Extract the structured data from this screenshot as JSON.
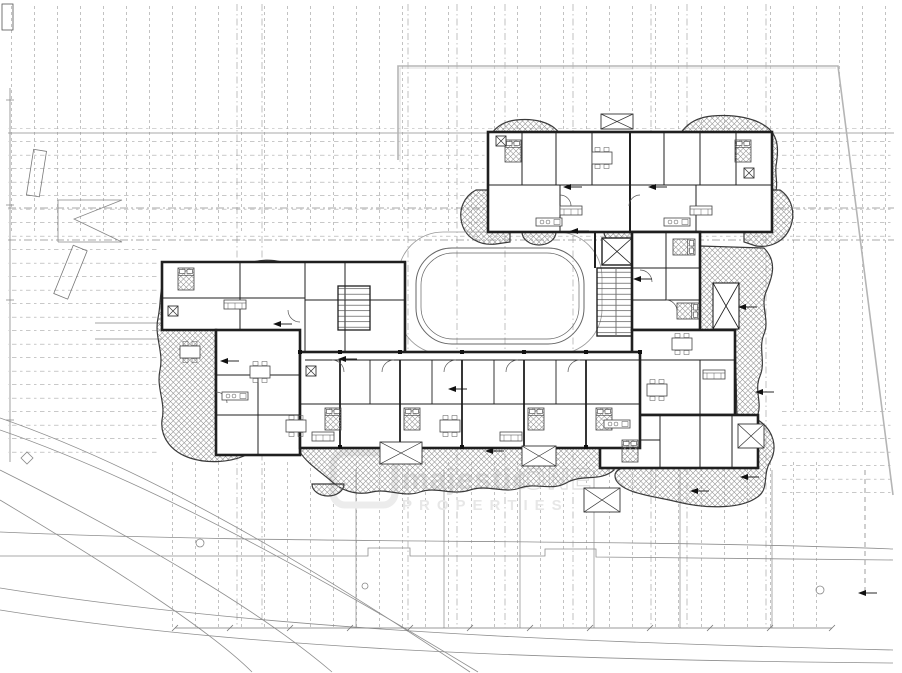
{
  "watermark": {
    "brand_script": "majestic",
    "brand_caps": "ONE",
    "line2": "PROPERTIES"
  },
  "drawing": {
    "kind": "architectural floor plan",
    "features": [
      "apartment-units",
      "terrace-hatch-areas",
      "pool-courtyard",
      "stair-cores",
      "elevator-shaft",
      "site-grid-lines",
      "site-boundary",
      "road-curves"
    ]
  },
  "colors": {
    "paper": "#ffffff",
    "ink": "#2a2a2a",
    "thin_line": "#555555",
    "grid_line": "#a0a0a0",
    "hatch_line": "#8f8f8f",
    "site_boundary": "#b5b5b5",
    "watermark_gray": "#e4e4e4"
  }
}
